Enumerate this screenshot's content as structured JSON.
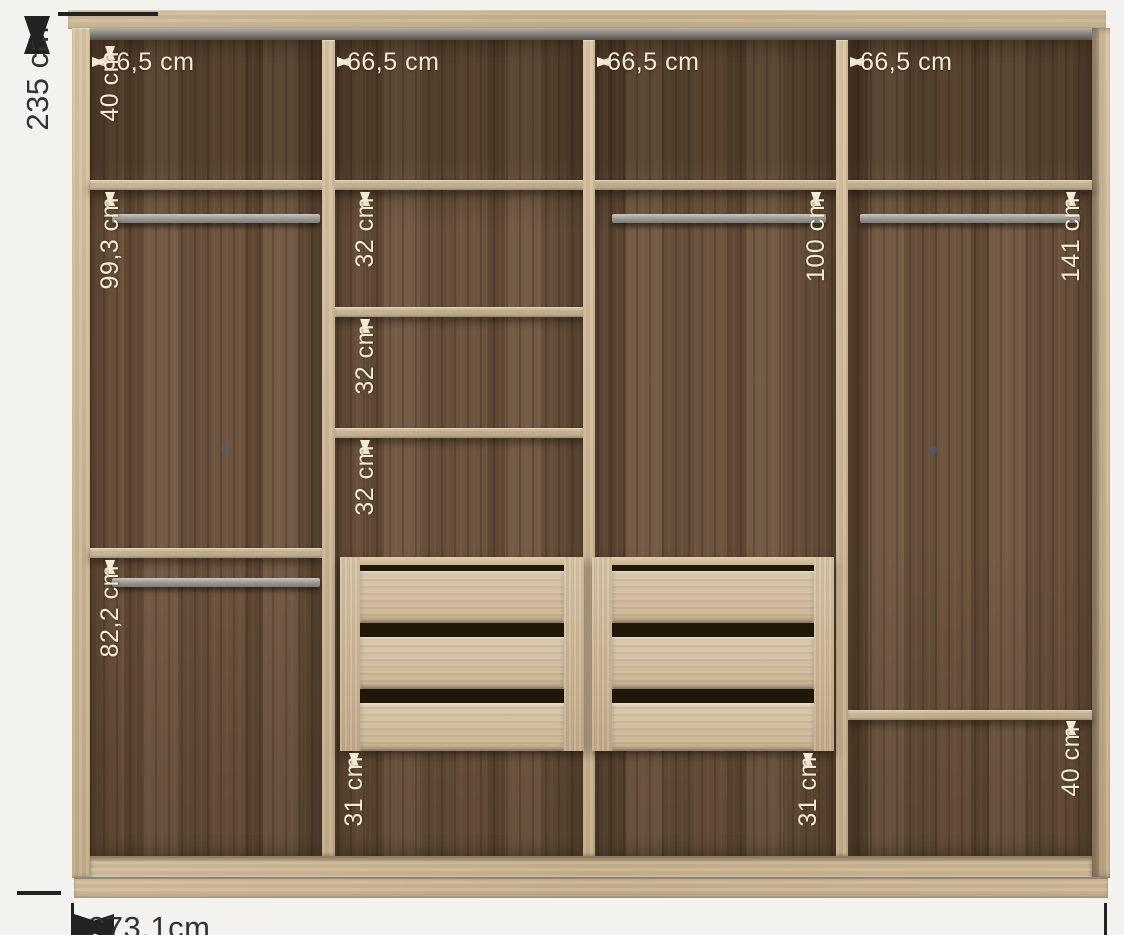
{
  "diagram": {
    "title": "wardrobe-internal-dimensions",
    "overall": {
      "height": "235 cm",
      "width": "273,1cm"
    },
    "columns": {
      "widths": [
        "66,5 cm",
        "66,5 cm",
        "66,5 cm",
        "66,5 cm"
      ]
    },
    "top_row": {
      "height": "40 cm"
    },
    "column1": {
      "upper": "99,3 cm",
      "lower": "82,2 cm"
    },
    "column2": {
      "shelves": [
        "32 cm",
        "32 cm",
        "32 cm"
      ],
      "bottom": "31 cm"
    },
    "column3": {
      "hanging": "100 cm",
      "bottom": "31 cm"
    },
    "column4": {
      "hanging": "141 cm",
      "bottom": "40 cm"
    },
    "colors": {
      "background": "#f4f2ef",
      "wood_dark": "#6b5440",
      "wood_light": "#cdb694",
      "rail_grey": "#97948e",
      "dimension_text_light": "#f3ead6",
      "dimension_text_dark": "#323232"
    }
  }
}
